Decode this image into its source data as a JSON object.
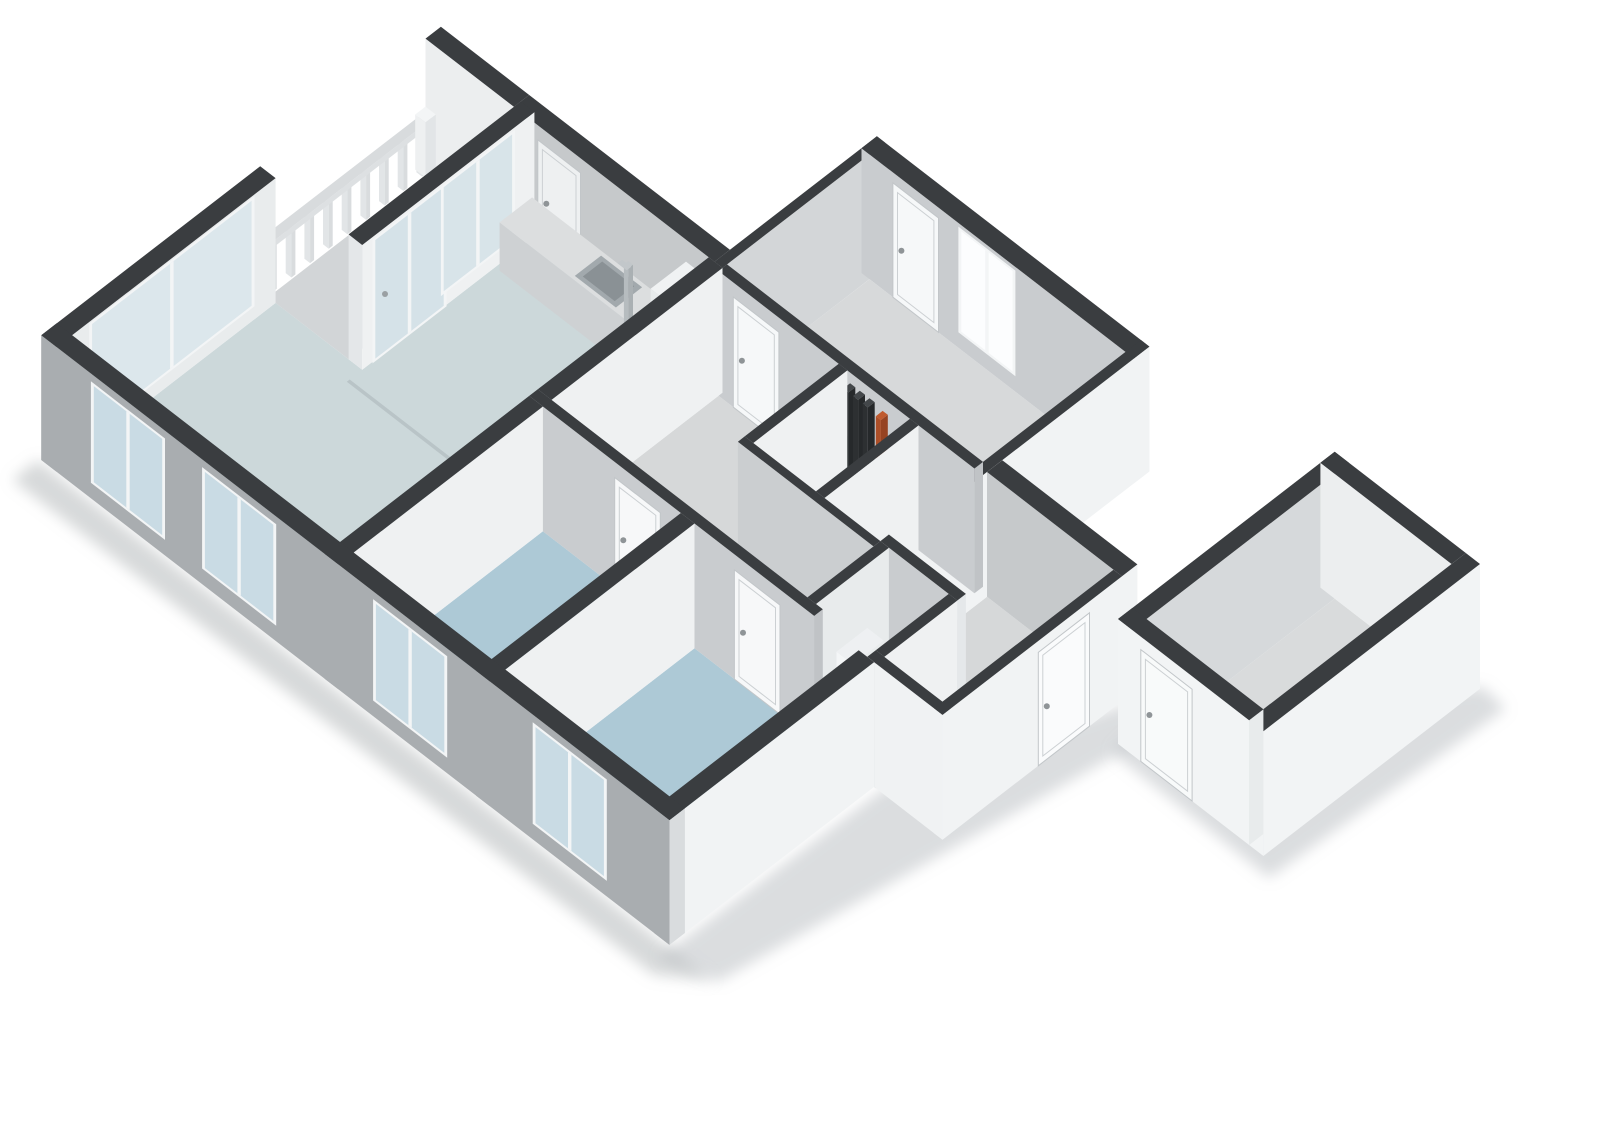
{
  "meta": {
    "label": "3D isometric floor plan render"
  },
  "projection": {
    "U": 57,
    "V": 44,
    "H": 52,
    "ox": 55,
    "oy": 460,
    "wallHeight": 2.4
  },
  "palette": {
    "wallTop": "#3a3d40",
    "facadeGray": "#a9adb0",
    "extWhite": "#f1f3f4",
    "intGray": "#c8cbce",
    "intLight": "#eef0f2",
    "floorLiving": "#ccd8da",
    "floorBedroom": "#adc9d6",
    "floorHall": "#d6d8d9",
    "floorToilet": "#2e8fc1",
    "glassExt": "#c9dbe4",
    "glassBright": "#fcfdfe",
    "frame": "#f3f5f6"
  },
  "scene": [
    {
      "t": "quad",
      "n": "shadow-south",
      "soft": true,
      "fill": "#a6abae",
      "op": 0.45,
      "pts": [
        [
          -0.15,
          -0.6,
          0
        ],
        [
          11.1,
          -0.6,
          0
        ],
        [
          11.7,
          -0.15,
          0
        ],
        [
          -0.15,
          -0.15,
          0
        ]
      ]
    },
    {
      "t": "quad",
      "n": "shadow-east",
      "soft": true,
      "fill": "#a6abae",
      "op": 0.4,
      "pts": [
        [
          10.95,
          -0.35,
          0
        ],
        [
          11.75,
          -0.1,
          0
        ],
        [
          12.75,
          6.55,
          0
        ],
        [
          12.2,
          6.7,
          0
        ],
        [
          11.0,
          3.5,
          0
        ]
      ]
    },
    {
      "t": "quad",
      "n": "shadow-storage",
      "soft": true,
      "fill": "#a6abae",
      "op": 0.4,
      "pts": [
        [
          12.6,
          5.95,
          0
        ],
        [
          15.4,
          5.9,
          0
        ],
        [
          15.55,
          9.9,
          0
        ],
        [
          15.1,
          9.95,
          0
        ],
        [
          12.55,
          6.25,
          0
        ]
      ]
    },
    {
      "t": "floor",
      "n": "floor-living-kitchen",
      "fill": "#ccd8da",
      "pts": [
        [
          0.15,
          0.15
        ],
        [
          4.85,
          0.15
        ],
        [
          4.85,
          6.62
        ],
        [
          1.67,
          6.62
        ],
        [
          1.67,
          3.72
        ],
        [
          0.15,
          3.72
        ]
      ]
    },
    {
      "t": "quad",
      "n": "floor-seam-living-kitchen",
      "fill": "#b9c4c7",
      "pts": [
        [
          1.67,
          3.45,
          0
        ],
        [
          4.85,
          3.45,
          0
        ],
        [
          4.85,
          3.5,
          0
        ],
        [
          1.67,
          3.5,
          0
        ]
      ]
    },
    {
      "t": "floor",
      "n": "floor-balcony",
      "fill": "#d2d5d7",
      "r": [
        0.02,
        3.72,
        1.43,
        6.62
      ]
    },
    {
      "t": "floor",
      "n": "floor-bedroom-1",
      "fill": "#adc9d6",
      "r": [
        5.09,
        0.15,
        7.51,
        3.47
      ]
    },
    {
      "t": "floor",
      "n": "floor-bedroom-2",
      "fill": "#adc9d6",
      "r": [
        7.75,
        0.15,
        10.63,
        3.47
      ]
    },
    {
      "t": "floor",
      "n": "floor-hall",
      "fill": "#d6d8d9",
      "pts": [
        [
          5.09,
          3.62
        ],
        [
          9.58,
          3.62
        ],
        [
          9.58,
          4.78
        ],
        [
          7.2,
          4.78
        ],
        [
          7.2,
          6.55
        ],
        [
          5.09,
          6.55
        ]
      ]
    },
    {
      "t": "floor",
      "n": "floor-closet-1",
      "fill": "#d4d6d8",
      "r": [
        7.35,
        4.9,
        8.45,
        6.55
      ]
    },
    {
      "t": "floor",
      "n": "floor-closet-2",
      "fill": "#d4d6d8",
      "r": [
        8.6,
        4.9,
        9.58,
        6.55
      ]
    },
    {
      "t": "floor",
      "n": "floor-bedroom-3",
      "fill": "#d7d9da",
      "r": [
        5.09,
        6.7,
        9.58,
        9.2
      ]
    },
    {
      "t": "floor",
      "n": "floor-toilet",
      "fill": "#2e8fc1",
      "r": [
        9.73,
        3.62,
        10.78,
        4.9
      ]
    },
    {
      "t": "floor",
      "n": "floor-entrance-hall",
      "fill": "#d6d8d9",
      "pts": [
        [
          10.93,
          3.62
        ],
        [
          11.95,
          3.62
        ],
        [
          11.95,
          6.62
        ],
        [
          9.73,
          6.62
        ],
        [
          9.73,
          5.05
        ],
        [
          10.93,
          5.05
        ]
      ]
    },
    {
      "t": "wall",
      "n": "wall-balcony-ne",
      "x1": -0.12,
      "y1": 6.62,
      "x2": 1.43,
      "y2": 6.89,
      "fy": "#eceeef",
      "fx": "#e6e9ea",
      "top": "#3a3d40"
    },
    {
      "t": "wall",
      "n": "wall-kitchen-ne",
      "x1": 1.43,
      "y1": 6.62,
      "x2": 4.95,
      "y2": 6.89,
      "fy": "#c6c9cb",
      "fx": "#c0c3c6",
      "top": "#3a3d40"
    },
    {
      "t": "door_y",
      "n": "door-kitchen-pantry",
      "y": 6.62,
      "u1": 1.85,
      "u2": 2.6,
      "h": 2.12,
      "fill": "#eef0f1"
    },
    {
      "t": "wall",
      "n": "wall-bedroom3-nw",
      "x1": 4.95,
      "y1": 6.62,
      "x2": 5.09,
      "y2": 9.47,
      "fy": "#c6c9cb",
      "fx": "#d3d6d8",
      "top": "#3a3d40"
    },
    {
      "t": "wall",
      "n": "wall-bedroom3-ne",
      "x1": 4.95,
      "y1": 9.2,
      "x2": 9.73,
      "y2": 9.47,
      "fy": "#c9cccf",
      "fx": "#f1f3f4",
      "top": "#3a3d40"
    },
    {
      "t": "door_y",
      "n": "door-bedroom3-exterior",
      "y": 9.2,
      "u1": 5.5,
      "u2": 6.3,
      "h": 2.2,
      "fill": "#f6f8f9"
    },
    {
      "t": "window_y",
      "n": "window-bedroom3",
      "y": 9.2,
      "u1": 6.7,
      "u2": 7.6,
      "z1": 0.35,
      "z2": 2.28,
      "glass": "#fcfdfe",
      "frame": "#f3f5f6"
    },
    {
      "t": "wall",
      "n": "wall-bedroom3-se",
      "x1": 9.58,
      "y1": 4.9,
      "x2": 9.73,
      "y2": 9.47,
      "fy": "#c9cccf",
      "fx": "#f1f3f4",
      "top": "#3a3d40"
    },
    {
      "t": "wall",
      "n": "wall-ne-entrance",
      "x1": 9.73,
      "y1": 6.62,
      "x2": 12.1,
      "y2": 6.89,
      "fy": "#c6c9cb",
      "fx": "#f1f3f4",
      "top": "#3a3d40"
    },
    {
      "t": "railing",
      "n": 9,
      "x": -0.1,
      "y1": 3.82,
      "y2": 6.44,
      "w": 0.07,
      "bh": 0.88,
      "fy": "#e2e5e7",
      "fx": "#d9dcde",
      "top": "#eef0f1"
    },
    {
      "t": "wall",
      "n": "railing-top-rail",
      "x1": -0.12,
      "y1": 3.78,
      "x2": 0.02,
      "y2": 6.6,
      "z0": 0.88,
      "z1": 1.0,
      "fy": "#e8ebed",
      "fx": "#dde0e2",
      "top": "#d8dbdd"
    },
    {
      "t": "wall",
      "n": "railing-corner-post",
      "x1": -0.14,
      "y1": 6.46,
      "x2": 0.04,
      "y2": 6.64,
      "z1": 1.06,
      "fy": "#eef0f1",
      "fx": "#e2e5e7",
      "top": "#f3f5f6"
    },
    {
      "t": "wall",
      "n": "wall-nw-living",
      "x1": -0.12,
      "y1": -0.12,
      "x2": 0.15,
      "y2": 3.72,
      "fy": "#a9adb0",
      "fx": "#e9eced",
      "top": "#3a3d40"
    },
    {
      "t": "window_x",
      "n": "window-living-nw-sliding",
      "x": 0.15,
      "v1": 0.5,
      "v2": 3.3,
      "z1": 0.3,
      "z2": 2.32,
      "glass": "#dce7ec",
      "frame": "#f3f5f6"
    },
    {
      "t": "wall",
      "n": "wall-balcony-door",
      "x1": 1.43,
      "y1": 3.72,
      "x2": 1.67,
      "y2": 6.74,
      "fy": "#e4e7e9",
      "fx": "#eff1f2",
      "top": "#3a3d40"
    },
    {
      "t": "window_x",
      "n": "door-balcony-glass",
      "x": 1.67,
      "v1": 3.95,
      "v2": 5.15,
      "z1": 0.02,
      "z2": 2.3,
      "glass": "#d5e2e8",
      "frame": "#f3f5f6"
    },
    {
      "t": "window_x",
      "n": "window-balcony-side",
      "x": 1.67,
      "v1": 5.15,
      "v2": 6.35,
      "z1": 0.3,
      "z2": 2.3,
      "glass": "#d8e4e9",
      "frame": "#f3f5f6"
    },
    {
      "t": "dot",
      "n": "handle-balcony-door",
      "X": 1.67,
      "Y": 4.12,
      "z": 1.12,
      "r": 3,
      "fill": "#9aa0a3"
    },
    {
      "t": "wall",
      "n": "kitchen-counter",
      "x1": 1.75,
      "y1": 6.05,
      "x2": 4.45,
      "y2": 6.62,
      "z1": 0.93,
      "fy": "#ced1d3",
      "fx": "#c4c7c9",
      "top": "#dcdedf"
    },
    {
      "t": "quad",
      "n": "kitchen-sink-rim",
      "fill": "#a2a9ad",
      "pts": [
        [
          3.02,
          6.1,
          0.935
        ],
        [
          3.74,
          6.1,
          0.935
        ],
        [
          3.74,
          6.56,
          0.935
        ],
        [
          3.02,
          6.56,
          0.935
        ]
      ]
    },
    {
      "t": "quad",
      "n": "kitchen-sink-basin",
      "fill": "#8a9195",
      "pts": [
        [
          3.1,
          6.16,
          0.94
        ],
        [
          3.66,
          6.16,
          0.94
        ],
        [
          3.66,
          6.5,
          0.94
        ],
        [
          3.1,
          6.5,
          0.94
        ]
      ]
    },
    {
      "t": "wall",
      "n": "kitchen-faucet",
      "x1": 3.49,
      "y1": 6.49,
      "x2": 3.57,
      "y2": 6.57,
      "z1": 1.22,
      "fy": "#b6bcbf",
      "fx": "#aab0b3",
      "top": "#c2c7ca"
    },
    {
      "t": "quad",
      "n": "kitchen-faucet-spout",
      "fill": "#c2c7ca",
      "pts": [
        [
          3.42,
          6.45,
          1.22
        ],
        [
          3.58,
          6.45,
          1.22
        ],
        [
          3.58,
          6.53,
          1.22
        ],
        [
          3.42,
          6.53,
          1.22
        ]
      ]
    },
    {
      "t": "wall",
      "n": "kitchen-tall-cabinet",
      "x1": 4.45,
      "y1": 6.0,
      "x2": 4.85,
      "y2": 6.62,
      "z1": 1.98,
      "fy": "#e8ebec",
      "fx": "#dde0e2",
      "top": "#f0f2f3"
    },
    {
      "t": "wall",
      "n": "wall-bedroom3-sw",
      "x1": 5.09,
      "y1": 6.55,
      "x2": 9.58,
      "y2": 6.7,
      "fy": "#c9cccf",
      "fx": "#c0c3c6",
      "top": "#3a3d40"
    },
    {
      "t": "door_y",
      "n": "door-bedroom3",
      "y": 6.55,
      "u1": 5.35,
      "u2": 6.15,
      "h": 2.12,
      "fill": "#f6f8f9"
    },
    {
      "t": "wall",
      "n": "closet-pipe-1",
      "x1": 7.55,
      "y1": 6.28,
      "x2": 7.64,
      "y2": 6.4,
      "z1": 2.45,
      "fy": "#2d3032",
      "fx": "#26292b",
      "top": "#43474a"
    },
    {
      "t": "wall",
      "n": "closet-pipe-2",
      "x1": 7.72,
      "y1": 6.28,
      "x2": 7.81,
      "y2": 6.4,
      "z1": 2.45,
      "fy": "#2d3032",
      "fx": "#26292b",
      "top": "#43474a"
    },
    {
      "t": "wall",
      "n": "closet-pipe-3",
      "x1": 7.89,
      "y1": 6.28,
      "x2": 7.98,
      "y2": 6.4,
      "z1": 2.45,
      "fy": "#2d3032",
      "fx": "#26292b",
      "top": "#43474a"
    },
    {
      "t": "wall",
      "n": "closet-pipe-orange",
      "x1": 8.12,
      "y1": 6.28,
      "x2": 8.21,
      "y2": 6.4,
      "z1": 2.4,
      "fy": "#ad4f28",
      "fx": "#964322",
      "top": "#c05a2e"
    },
    {
      "t": "wall",
      "n": "wall-closet-partition-1",
      "x1": 7.2,
      "y1": 4.9,
      "x2": 7.35,
      "y2": 6.55,
      "fy": "#cbced0",
      "fx": "#eff1f2",
      "top": "#3a3d40"
    },
    {
      "t": "wall",
      "n": "wall-closet-partition-2",
      "x1": 8.45,
      "y1": 4.9,
      "x2": 8.6,
      "y2": 6.55,
      "fy": "#cbced0",
      "fx": "#eff1f2",
      "top": "#3a3d40"
    },
    {
      "t": "wall",
      "n": "wall-closet-front",
      "x1": 7.2,
      "y1": 4.78,
      "x2": 9.58,
      "y2": 4.9,
      "fy": "#cbced0",
      "fx": "#e5e8ea",
      "top": "#3a3d40"
    },
    {
      "t": "wall",
      "n": "wall-hall-spur-nw",
      "x1": 4.85,
      "y1": 3.62,
      "x2": 5.09,
      "y2": 6.62,
      "fy": "#cbced0",
      "fx": "#eff1f2",
      "top": "#3a3d40"
    },
    {
      "t": "wall",
      "n": "wall-toilet-ne",
      "x1": 9.58,
      "y1": 4.9,
      "x2": 10.93,
      "y2": 5.05,
      "fy": "#c9cccf",
      "fx": "#e5e8ea",
      "top": "#3a3d40"
    },
    {
      "t": "wall",
      "n": "wall-toilet-nw",
      "x1": 9.58,
      "y1": 3.62,
      "x2": 9.73,
      "y2": 4.9,
      "fy": "#cbced0",
      "fx": "#e8ebec",
      "top": "#3a3d40"
    },
    {
      "t": "wall",
      "n": "toilet-cistern",
      "x1": 9.73,
      "y1": 3.98,
      "x2": 10.02,
      "y2": 4.52,
      "z1": 1.18,
      "fy": "#f4f6f7",
      "fx": "#e9eced",
      "top": "#eef0f2"
    },
    {
      "t": "ellipse",
      "n": "toilet-bowl",
      "X": 10.3,
      "Y": 4.26,
      "z": 0.5,
      "rx": 15,
      "ry": 10.5,
      "fill": "#f5f7f8"
    },
    {
      "t": "ellipse",
      "n": "toilet-seat",
      "X": 10.32,
      "Y": 4.27,
      "z": 0.52,
      "rx": 10,
      "ry": 6.5,
      "fill": "#e6eaec"
    },
    {
      "t": "wall",
      "n": "wall-toilet-se",
      "x1": 10.78,
      "y1": 3.62,
      "x2": 10.93,
      "y2": 4.9,
      "fy": "#cbced0",
      "fx": "#eff1f2",
      "top": "#3a3d40"
    },
    {
      "t": "wall",
      "n": "wall-hall-sw-left",
      "x1": 4.85,
      "y1": 3.47,
      "x2": 9.85,
      "y2": 3.62,
      "fy": "#c9cccf",
      "fx": "#c0c3c6",
      "top": "#3a3d40"
    },
    {
      "t": "door_y",
      "n": "door-bedroom-1",
      "y": 3.47,
      "u1": 6.35,
      "u2": 7.15,
      "h": 2.1,
      "fill": "#f7f8f9"
    },
    {
      "t": "door_y",
      "n": "door-bedroom-2",
      "y": 3.47,
      "u1": 8.45,
      "u2": 9.25,
      "h": 2.1,
      "fill": "#f7f8f9"
    },
    {
      "t": "wall",
      "n": "wall-hall-sw-stub",
      "x1": 10.78,
      "y1": 3.47,
      "x2": 10.93,
      "y2": 3.62,
      "fy": "#c9cccf",
      "fx": "#eff1f2",
      "top": "#3a3d40"
    },
    {
      "t": "wall",
      "n": "wall-divider-living-bed1",
      "x1": 4.85,
      "y1": -0.12,
      "x2": 5.09,
      "y2": 3.47,
      "fy": "#a9adb0",
      "fx": "#eff1f2",
      "top": "#3a3d40"
    },
    {
      "t": "wall",
      "n": "wall-divider-bed1-bed2",
      "x1": 7.51,
      "y1": -0.12,
      "x2": 7.75,
      "y2": 3.47,
      "fy": "#a9adb0",
      "fx": "#eff1f2",
      "top": "#3a3d40"
    },
    {
      "t": "wall",
      "n": "wall-jog-south",
      "x1": 10.9,
      "y1": 3.47,
      "x2": 12.1,
      "y2": 3.62,
      "fy": "#f0f2f3",
      "fx": "#e5e8ea",
      "top": "#3a3d40"
    },
    {
      "t": "wall",
      "n": "wall-end-se",
      "x1": 11.95,
      "y1": 3.47,
      "x2": 12.1,
      "y2": 6.62,
      "fy": "#f0f2f3",
      "fx": "#f1f3f4",
      "top": "#3a3d40"
    },
    {
      "t": "door_x",
      "n": "door-entrance",
      "x": 12.1,
      "v1": 5.15,
      "v2": 6.05,
      "h": 2.18,
      "fill": "#fafbfc"
    },
    {
      "t": "wall",
      "n": "wall-bedroom2-se",
      "x1": 10.63,
      "y1": -0.12,
      "x2": 10.9,
      "y2": 3.47,
      "fy": "#a9adb0",
      "fx": "#f1f3f4",
      "top": "#3a3d40"
    },
    {
      "t": "wall",
      "n": "wall-facade-sw",
      "x1": -0.12,
      "y1": -0.12,
      "x2": 10.9,
      "y2": 0.15,
      "fy": "#a9adb0",
      "fx": "#d9dcde",
      "top": "#3a3d40"
    },
    {
      "t": "window_y",
      "n": "window-living-1",
      "y": -0.12,
      "u1": 0.8,
      "u2": 2.0,
      "z1": 0.35,
      "z2": 2.2,
      "glass": "#c9dbe4",
      "frame": "#f3f5f6"
    },
    {
      "t": "window_y",
      "n": "window-living-2",
      "y": -0.12,
      "u1": 2.75,
      "u2": 3.95,
      "z1": 0.35,
      "z2": 2.2,
      "glass": "#c9dbe4",
      "frame": "#f3f5f6"
    },
    {
      "t": "window_y",
      "n": "window-bedroom-1",
      "y": -0.12,
      "u1": 5.75,
      "u2": 6.95,
      "z1": 0.35,
      "z2": 2.2,
      "glass": "#c9dbe4",
      "frame": "#f3f5f6"
    },
    {
      "t": "window_y",
      "n": "window-bedroom-2",
      "y": -0.12,
      "u1": 8.55,
      "u2": 9.75,
      "z1": 0.35,
      "z2": 2.2,
      "glass": "#c9dbe4",
      "frame": "#f3f5f6"
    },
    {
      "t": "floor",
      "n": "floor-storage",
      "fill": "#d9dbdc",
      "r": [
        12.8,
        6.35,
        14.85,
        9.65
      ]
    },
    {
      "t": "wall",
      "n": "wall-storage-nw",
      "x1": 12.55,
      "y1": 6.1,
      "x2": 12.8,
      "y2": 9.9,
      "fy": "#f2f4f5",
      "fx": "#d6d9db",
      "top": "#3a3d40"
    },
    {
      "t": "wall",
      "n": "wall-storage-ne",
      "x1": 12.55,
      "y1": 9.65,
      "x2": 14.85,
      "y2": 9.9,
      "fy": "#eceeef",
      "fx": "#f2f4f5",
      "top": "#3a3d40"
    },
    {
      "t": "wall",
      "n": "wall-storage-se",
      "x1": 14.85,
      "y1": 6.1,
      "x2": 15.1,
      "y2": 9.9,
      "fy": "#f2f4f5",
      "fx": "#f2f4f5",
      "top": "#3a3d40"
    },
    {
      "t": "wall",
      "n": "wall-storage-sw",
      "x1": 12.55,
      "y1": 6.1,
      "x2": 14.85,
      "y2": 6.35,
      "fy": "#f2f4f5",
      "fx": "#e8ebec",
      "top": "#3a3d40"
    },
    {
      "t": "door_y",
      "n": "door-storage",
      "y": 6.1,
      "u1": 12.95,
      "u2": 13.85,
      "h": 2.15,
      "fill": "#f8fafa"
    }
  ]
}
